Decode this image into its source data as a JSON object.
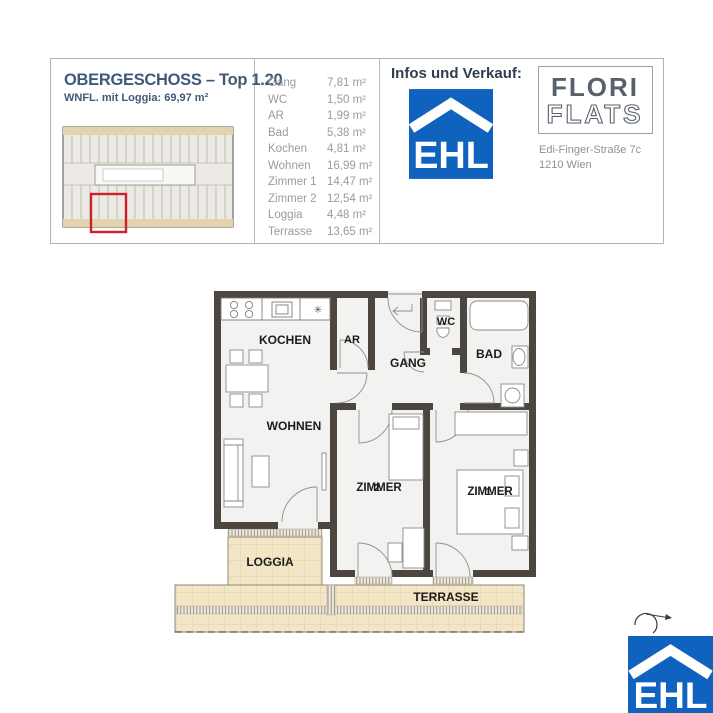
{
  "unit_panel": {
    "title": "OBERGESCHOSS – Top 1.20",
    "subtitle": "WNFL. mit Loggia: 69,97 m²"
  },
  "room_list": [
    {
      "name": "Gang",
      "area": "7,81 m²"
    },
    {
      "name": "WC",
      "area": "1,50 m²"
    },
    {
      "name": "AR",
      "area": "1,99 m²"
    },
    {
      "name": "Bad",
      "area": "5,38 m²"
    },
    {
      "name": "Kochen",
      "area": "4,81 m²"
    },
    {
      "name": "Wohnen",
      "area": "16,99 m²"
    },
    {
      "name": "Zimmer 1",
      "area": "14,47 m²"
    },
    {
      "name": "Zimmer 2",
      "area": "12,54 m²"
    },
    {
      "name": "Loggia",
      "area": "4,48 m²"
    },
    {
      "name": "Terrasse",
      "area": "13,65 m²"
    }
  ],
  "sales_panel": {
    "heading": "Infos und Verkauf:",
    "ehl_logo": "EHL",
    "brand": {
      "line1": "FLORI",
      "line2": "FLATS"
    },
    "address": {
      "line1": "Edi-Finger-Straße 7c",
      "line2": "1210 Wien"
    }
  },
  "floor_plan": {
    "labels": {
      "kochen": "KOCHEN",
      "ar": "AR",
      "wc": "WC",
      "gang": "GANG",
      "bad": "BAD",
      "wohnen": "WOHNEN",
      "zimmer_left": "ZIMMER",
      "zimmer_left_num": "2",
      "zimmer_right": "ZIMMER",
      "zimmer_right_num": "1",
      "loggia": "LOGGIA",
      "terrasse": "TERRASSE"
    }
  },
  "footer": {
    "ehl_logo": "EHL"
  },
  "colors": {
    "ehl_blue": "#0f63be",
    "wall": "#4b4640",
    "outdoor_beige": "#f3e6c6",
    "highlight_red": "#d02027",
    "heading_navy": "#3e5a77"
  }
}
